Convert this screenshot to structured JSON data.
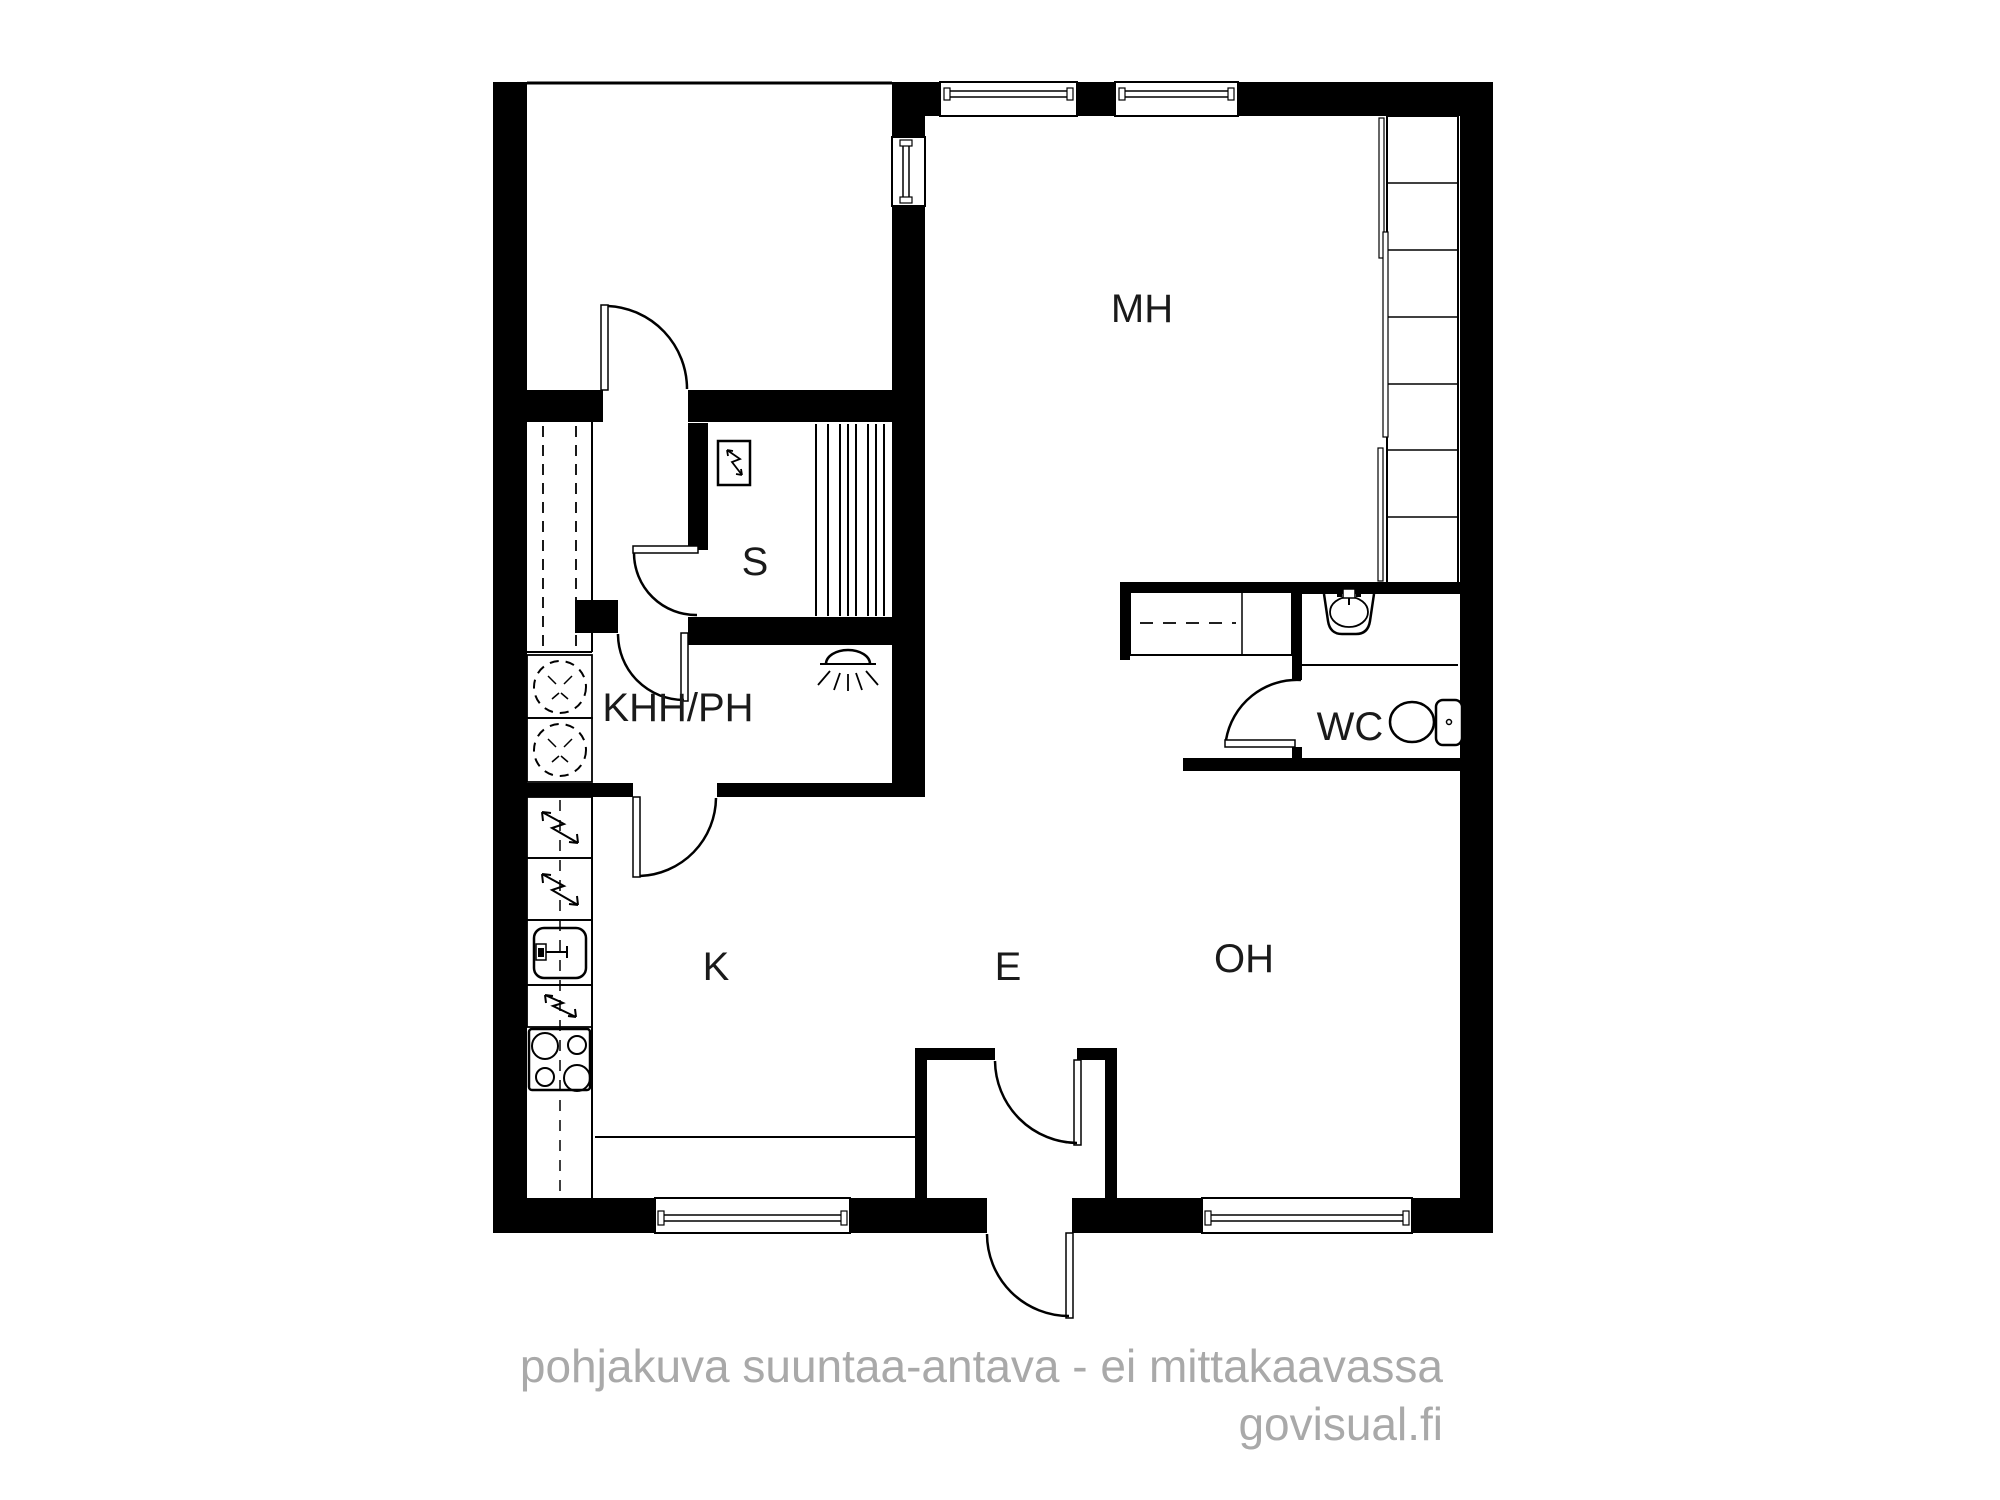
{
  "page": {
    "background": "#ffffff"
  },
  "floor_plan": {
    "room_labels": [
      {
        "id": "mh",
        "label": "MH"
      },
      {
        "id": "s",
        "label": "S"
      },
      {
        "id": "khh_ph",
        "label": "KHH/PH"
      },
      {
        "id": "wc",
        "label": "WC"
      },
      {
        "id": "k",
        "label": "K"
      },
      {
        "id": "e",
        "label": "E"
      },
      {
        "id": "oh",
        "label": "OH"
      }
    ],
    "colors": {
      "wall": "#000000",
      "line": "#000000",
      "room_label": "#1a1a1a",
      "footer_text": "#a9a9a9",
      "background": "#ffffff"
    },
    "icons": {
      "sauna_heater": "lightning-in-box",
      "electrical_appliance": "lightning-bolt",
      "washing_machine": "dashed-circle",
      "kitchen_sink": "basin-with-tap",
      "stove": "four-burner-hob",
      "shower": "shower-head",
      "wc_sink": "basin-with-tap",
      "toilet": "toilet-with-cistern",
      "wardrobe": "dashed-rail-cabinet",
      "closet": "shelved-closet"
    }
  },
  "footer": {
    "disclaimer": "pohjakuva suuntaa-antava - ei mittakaavassa",
    "brand": "govisual.fi"
  }
}
